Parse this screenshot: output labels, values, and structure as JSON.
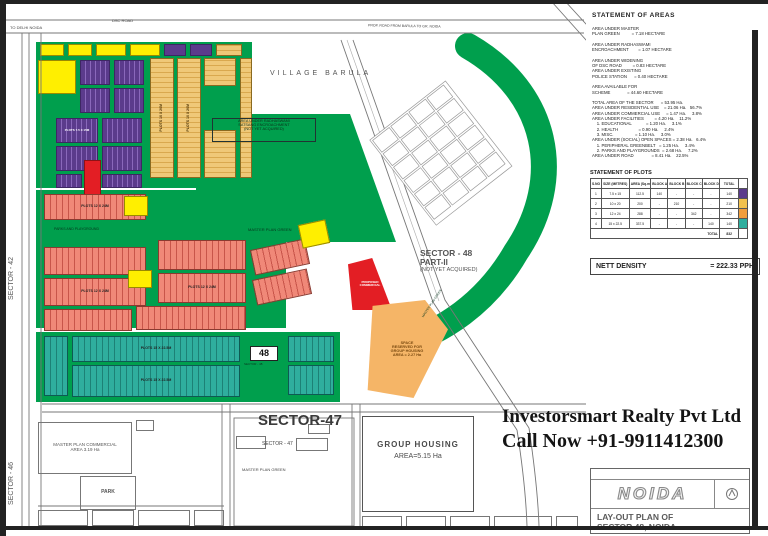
{
  "watermark": {
    "line1": "Investorsmart Realty Pvt Ltd",
    "line2": "Call Now +91-9911412300"
  },
  "footer": "For Selling/Purchasing/Renting Of Property Contact Khalid Properties",
  "roads": {
    "dsc": "DSC ROAD",
    "to_delhi": "TO DELHI NOIDA",
    "top": "PROP. ROAD FROM BARULA TO GR. NOIDA"
  },
  "sectors": {
    "s42": "SECTOR - 42",
    "s46": "SECTOR - 46",
    "s47_big": "SECTOR-47",
    "s47_small": "SECTOR - 47",
    "s47_green": "MASTER PLAN GREEN",
    "s48_l1": "SECTOR - 48",
    "s48_l2": "PART-II",
    "s48_l3": "(NOT YET ACQUIRED)",
    "village": "VILLAGE BARULA",
    "badge48": "48",
    "badge48_sub": "SECTOR - 48"
  },
  "areas": {
    "group_housing_l1": "GROUP HOUSING",
    "group_housing_l2": "AREA=5.15 Ha",
    "mpc_l1": "MASTER PLAN COMMERCIAL",
    "mpc_l2": "AREA  3.19 Ha",
    "park": "PARK",
    "mp_green": "MASTER PLAN GREEN",
    "center_l1": "AREA UNDER RADHASWAMI",
    "center_l2": "SATSANG ENCROACHMENT",
    "center_l3": "(NOT YET ACQUIRED)",
    "space_l1": "SPACE",
    "space_l2": "RESERVED FOR",
    "space_l3": "GROUP HOUSING",
    "space_l4": "AREA = 2.27 Ha",
    "comm_l1": "PROPOSED",
    "comm_l2": "COMMERCIAL",
    "parks_band": "PARKS AND PLAYGROUND"
  },
  "plots": {
    "purple": "PLOTS 7.5 X 15M",
    "tan": "PLOTS 10 X 20M",
    "salmon": "PLOTS 12 X 24M",
    "teal": "PLOTS 15 X 22.5M"
  },
  "panel": {
    "areas_title": "STATEMENT OF AREAS",
    "area_lines": [
      "AREA UNDER MASTER",
      "PLAN GREEN          = 7.18 HECTARE",
      "",
      "AREA UNDER RADHASWAMI",
      "ENCROACHMENT        = 1.07 HECTARE",
      "",
      "AREA UNDER WIDENING",
      "OF DSC ROAD         = 0.83 HECTARE",
      "AREA UNDER EXISTING",
      "POLICE STATION      = 0.40 HECTARE",
      "",
      "AREA AVAILABLE FOR",
      "SCHEME              = 44.60 HECTARE",
      "",
      "TOTAL AREA OF THE SECTOR      = 53.95 Ha.",
      "AREA UNDER RESIDENTIAL USE    = 21.06 Ha.   56.7%",
      "AREA UNDER COMMERCIAL USE     = 1.47 Ha.     3.8%",
      "AREA UNDER FACILITIES         = 4.20 Ha.    11.2%",
      "    1. EDUCATIONAL            = 1.20 Ha.     3.1%",
      "    2. HEALTH                 = 0.90 Ha.     2.4%",
      "    3. MISC.                  = 1.10 Ha.     3.0%",
      "AREA UNDER (SOCIAL) OPEN SPACES = 2.38 Ha.   6.4%",
      "    1. PERIPHERAL GREENBELT   = 1.25 Ha.     3.4%",
      "    2. PARKS AND PLAYGROUNDS  = 2.68 Ha.     7.2%",
      "AREA UNDER ROAD               = 8.41 Ha.    22.5%"
    ],
    "plots_title": "STATEMENT OF PLOTS",
    "table": {
      "headers": [
        "S.NO",
        "SIZE (METRES)",
        "AREA (Sq.m)",
        "BLOCK A",
        "BLOCK B",
        "BLOCK C",
        "BLOCK D",
        "TOTAL"
      ],
      "rows": [
        [
          "1",
          "7.5 x 15",
          "112.5",
          "140",
          "-",
          "-",
          "-",
          "140"
        ],
        [
          "2",
          "10 x 20",
          "200",
          "-",
          "210",
          "-",
          "-",
          "210"
        ],
        [
          "3",
          "12 x 24",
          "288",
          "-",
          "-",
          "342",
          "-",
          "342"
        ],
        [
          "4",
          "15 x 22.5",
          "337.5",
          "-",
          "-",
          "-",
          "140",
          "140"
        ]
      ],
      "sw": [
        "background:#5b3b8c",
        "background:#f2c14e",
        "background:#f09d3c",
        "background:#2fae9e"
      ],
      "total_label": "TOTAL",
      "total_value": "832"
    },
    "density_label": "NETT DENSITY",
    "density_value": "= 222.33 PPH",
    "logo": "NOIDA",
    "title_l1": "LAY-OUT PLAN OF",
    "title_l2": "SECTOR 48, NOIDA"
  },
  "colors": {
    "green": "#009f4d",
    "purple": "#5b3b8c",
    "yellow": "#ffef00",
    "tan": "#efc878",
    "salmon": "#f08878",
    "teal": "#2fae9e",
    "red": "#e31e24",
    "orange": "#f5b567"
  }
}
